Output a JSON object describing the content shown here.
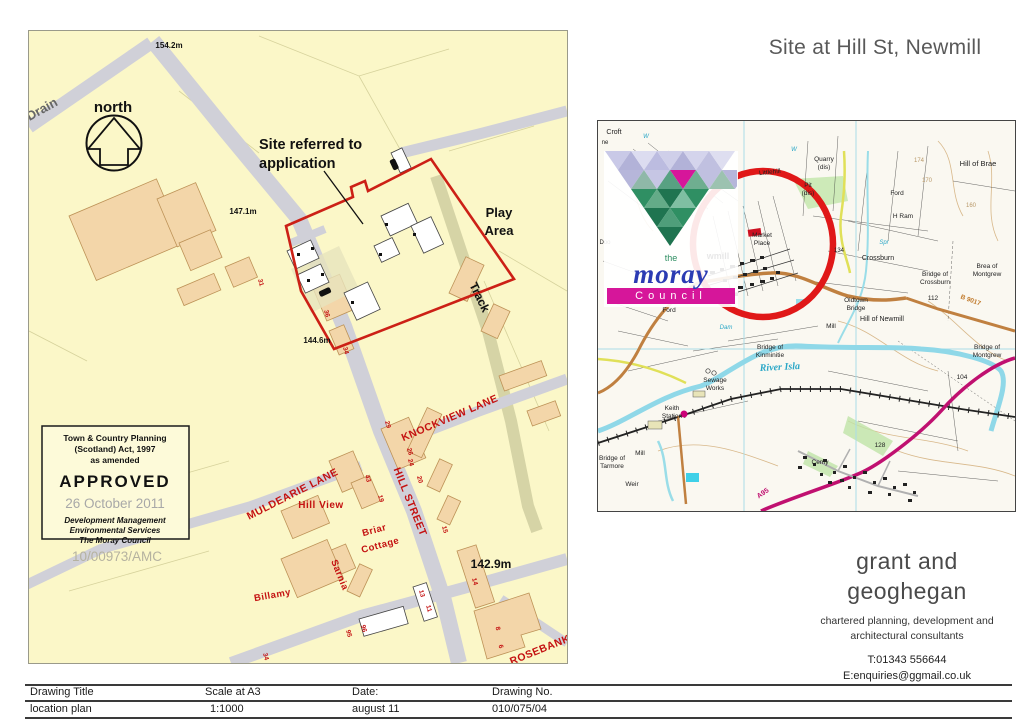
{
  "header": {
    "title": "Site at Hill St, Newmill"
  },
  "location_plan": {
    "site_note_line1": "Site referred to",
    "site_note_line2": "application",
    "labels": [
      {
        "t": "Drain",
        "x": 15,
        "y": 82,
        "s": 13,
        "c": "gray2",
        "r": -29
      },
      {
        "t": "north",
        "x": 84,
        "y": 81,
        "s": 15,
        "c": "blk"
      },
      {
        "t": "154.2m",
        "x": 140,
        "y": 17,
        "s": 8,
        "c": "blk"
      },
      {
        "t": "147.1m",
        "x": 214,
        "y": 183,
        "s": 8,
        "c": "blk"
      },
      {
        "t": "144.6m",
        "x": 288,
        "y": 312,
        "s": 8,
        "c": "blk"
      },
      {
        "t": "142.9m",
        "x": 462,
        "y": 537,
        "s": 12,
        "c": "blk"
      },
      {
        "t": "Play",
        "x": 470,
        "y": 186,
        "s": 13,
        "c": "blk"
      },
      {
        "t": "Area",
        "x": 470,
        "y": 204,
        "s": 13,
        "c": "blk"
      },
      {
        "t": "Track",
        "x": 447,
        "y": 268,
        "s": 12,
        "c": "blk",
        "r": 64
      },
      {
        "t": "KNOCKVIEW LANE",
        "x": 422,
        "y": 390,
        "s": 10.5,
        "c": "street",
        "r": -23
      },
      {
        "t": "HILL STREET",
        "x": 378,
        "y": 472,
        "s": 10.5,
        "c": "street",
        "r": 68
      },
      {
        "t": "MULDEARIE LANE",
        "x": 265,
        "y": 466,
        "s": 10.5,
        "c": "street",
        "r": -27
      },
      {
        "t": "ROSEBANK L",
        "x": 517,
        "y": 620,
        "s": 10.5,
        "c": "street",
        "r": -22
      },
      {
        "t": "Hill View",
        "x": 292,
        "y": 477,
        "s": 10,
        "c": "street"
      },
      {
        "t": "Briar",
        "x": 346,
        "y": 502,
        "s": 9.5,
        "c": "street",
        "r": -15
      },
      {
        "t": "Cottage",
        "x": 352,
        "y": 517,
        "s": 9.5,
        "c": "street",
        "r": -15
      },
      {
        "t": "Sarnia",
        "x": 308,
        "y": 545,
        "s": 9.5,
        "c": "street",
        "r": 68
      },
      {
        "t": "Billamy",
        "x": 244,
        "y": 567,
        "s": 9.5,
        "c": "street",
        "r": -10
      }
    ],
    "numbers": [
      {
        "t": "31",
        "x": 230,
        "y": 252,
        "s": 6.5,
        "c": "num",
        "r": 75
      },
      {
        "t": "36",
        "x": 296,
        "y": 283,
        "s": 6.5,
        "c": "num",
        "r": 75
      },
      {
        "t": "34",
        "x": 315,
        "y": 320,
        "s": 6.5,
        "c": "num",
        "r": 75
      },
      {
        "t": "29",
        "x": 357,
        "y": 394,
        "s": 6.5,
        "c": "num",
        "r": 75
      },
      {
        "t": "43",
        "x": 337,
        "y": 448,
        "s": 6.5,
        "c": "num",
        "r": 75
      },
      {
        "t": "19",
        "x": 350,
        "y": 468,
        "s": 6.5,
        "c": "num",
        "r": 75
      },
      {
        "t": "26",
        "x": 379,
        "y": 421,
        "s": 6.5,
        "c": "num",
        "r": 75
      },
      {
        "t": "24",
        "x": 380,
        "y": 432,
        "s": 6.5,
        "c": "num",
        "r": 75
      },
      {
        "t": "20",
        "x": 389,
        "y": 449,
        "s": 6.5,
        "c": "num",
        "r": 75
      },
      {
        "t": "15",
        "x": 414,
        "y": 499,
        "s": 6.5,
        "c": "num",
        "r": 75
      },
      {
        "t": "13",
        "x": 391,
        "y": 563,
        "s": 6.5,
        "c": "num",
        "r": 75
      },
      {
        "t": "11",
        "x": 398,
        "y": 578,
        "s": 6.5,
        "c": "num",
        "r": 75
      },
      {
        "t": "95",
        "x": 318,
        "y": 603,
        "s": 6.5,
        "c": "num",
        "r": 75
      },
      {
        "t": "96",
        "x": 333,
        "y": 598,
        "s": 6.5,
        "c": "num",
        "r": 75
      },
      {
        "t": "14",
        "x": 444,
        "y": 551,
        "s": 6.5,
        "c": "num",
        "r": 75
      },
      {
        "t": "8",
        "x": 467,
        "y": 598,
        "s": 6.5,
        "c": "num",
        "r": 75
      },
      {
        "t": "6",
        "x": 470,
        "y": 616,
        "s": 6.5,
        "c": "num",
        "r": 75
      },
      {
        "t": "34",
        "x": 235,
        "y": 626,
        "s": 6.5,
        "c": "num",
        "r": 75
      }
    ],
    "stamp": {
      "line1": "Town & Country Planning",
      "line2": "(Scotland) Act, 1997",
      "line3": "as amended",
      "approved": "APPROVED",
      "date": "26 October 2011",
      "dept1": "Development Management",
      "dept2": "Environmental Services",
      "dept3": "The Moray Council",
      "ref": "10/00973/AMC"
    }
  },
  "os_map": {
    "labels": [
      {
        "t": "Croft",
        "x": 16,
        "y": 13,
        "s": 7,
        "c": "os"
      },
      {
        "t": "ne",
        "x": 7,
        "y": 23,
        "s": 6,
        "c": "os"
      },
      {
        "t": "W",
        "x": 48,
        "y": 17,
        "s": 6,
        "c": "osc"
      },
      {
        "t": "W",
        "x": 196,
        "y": 30,
        "s": 6,
        "c": "osc"
      },
      {
        "t": "Quarry",
        "x": 226,
        "y": 40,
        "s": 6.5,
        "c": "os"
      },
      {
        "t": "(dis)",
        "x": 226,
        "y": 48,
        "s": 6.5,
        "c": "os"
      },
      {
        "t": "Littlehill",
        "x": 172,
        "y": 53,
        "s": 6.5,
        "c": "os",
        "r": -6
      },
      {
        "t": "Pit",
        "x": 210,
        "y": 66,
        "s": 6.5,
        "c": "os"
      },
      {
        "t": "(dis)",
        "x": 210,
        "y": 74,
        "s": 6.5,
        "c": "os"
      },
      {
        "t": "Hill of Brae",
        "x": 380,
        "y": 45,
        "s": 7.5,
        "c": "os"
      },
      {
        "t": "174",
        "x": 321,
        "y": 41,
        "s": 6,
        "c": "ost"
      },
      {
        "t": "170",
        "x": 329,
        "y": 61,
        "s": 6,
        "c": "ost"
      },
      {
        "t": "160",
        "x": 373,
        "y": 86,
        "s": 6,
        "c": "ost"
      },
      {
        "t": "Ford",
        "x": 299,
        "y": 74,
        "s": 6.5,
        "c": "os"
      },
      {
        "t": "H Ram",
        "x": 305,
        "y": 97,
        "s": 6.5,
        "c": "os"
      },
      {
        "t": "Spr",
        "x": 286,
        "y": 123,
        "s": 6,
        "c": "osc"
      },
      {
        "t": "Crossburn",
        "x": 280,
        "y": 139,
        "s": 7,
        "c": "os"
      },
      {
        "t": "Bridge of",
        "x": 337,
        "y": 155,
        "s": 6.5,
        "c": "os"
      },
      {
        "t": "Crossburn",
        "x": 337,
        "y": 163,
        "s": 6.5,
        "c": "os"
      },
      {
        "t": "Brea of",
        "x": 389,
        "y": 147,
        "s": 6.5,
        "c": "os"
      },
      {
        "t": "Montgrew",
        "x": 389,
        "y": 155,
        "s": 6.5,
        "c": "os"
      },
      {
        "t": "112",
        "x": 335,
        "y": 179,
        "s": 6.5,
        "c": "os"
      },
      {
        "t": "B 9017",
        "x": 372,
        "y": 181,
        "s": 6.5,
        "c": "oso",
        "r": 20
      },
      {
        "t": "Oldtown",
        "x": 258,
        "y": 181,
        "s": 6.5,
        "c": "os"
      },
      {
        "t": "Bridge",
        "x": 258,
        "y": 189,
        "s": 6.5,
        "c": "os"
      },
      {
        "t": "Hill of Newmill",
        "x": 284,
        "y": 200,
        "s": 7,
        "c": "os"
      },
      {
        "t": "Mill",
        "x": 233,
        "y": 207,
        "s": 6.5,
        "c": "os"
      },
      {
        "t": "134",
        "x": 241,
        "y": 131,
        "s": 6,
        "c": "os"
      },
      {
        "t": "Market",
        "x": 164,
        "y": 116,
        "s": 6.5,
        "c": "os"
      },
      {
        "t": "Place",
        "x": 164,
        "y": 124,
        "s": 6.5,
        "c": "os"
      },
      {
        "t": "wmill",
        "x": 120,
        "y": 138,
        "s": 9,
        "c": "osbb"
      },
      {
        "t": "Dam",
        "x": 128,
        "y": 208,
        "s": 6,
        "c": "osc"
      },
      {
        "t": "Ford",
        "x": 71,
        "y": 191,
        "s": 6.5,
        "c": "os"
      },
      {
        "t": "Doo",
        "x": 7,
        "y": 123,
        "s": 6,
        "c": "os"
      },
      {
        "t": "Bridge of",
        "x": 172,
        "y": 228,
        "s": 6.5,
        "c": "os"
      },
      {
        "t": "Kinminitie",
        "x": 172,
        "y": 236,
        "s": 6.5,
        "c": "os"
      },
      {
        "t": "River Isla",
        "x": 182,
        "y": 249,
        "s": 10,
        "c": "oscb",
        "r": -3
      },
      {
        "t": "Sewage",
        "x": 117,
        "y": 261,
        "s": 6.5,
        "c": "os"
      },
      {
        "t": "Works",
        "x": 117,
        "y": 269,
        "s": 6.5,
        "c": "os"
      },
      {
        "t": "Keith",
        "x": 74,
        "y": 289,
        "s": 6.5,
        "c": "os"
      },
      {
        "t": "Station",
        "x": 74,
        "y": 297,
        "s": 6.5,
        "c": "os"
      },
      {
        "t": "Mill",
        "x": 42,
        "y": 334,
        "s": 6.5,
        "c": "os"
      },
      {
        "t": "Bridge of",
        "x": 14,
        "y": 339,
        "s": 6.5,
        "c": "os"
      },
      {
        "t": "Tarmore",
        "x": 14,
        "y": 347,
        "s": 6.5,
        "c": "os"
      },
      {
        "t": "Weir",
        "x": 34,
        "y": 365,
        "s": 6.5,
        "c": "os"
      },
      {
        "t": "Cemy",
        "x": 222,
        "y": 343,
        "s": 6.5,
        "c": "os"
      },
      {
        "t": "128",
        "x": 282,
        "y": 326,
        "s": 6.5,
        "c": "os"
      },
      {
        "t": "104",
        "x": 364,
        "y": 258,
        "s": 6.5,
        "c": "os"
      },
      {
        "t": "Bridge of",
        "x": 389,
        "y": 228,
        "s": 6.5,
        "c": "os"
      },
      {
        "t": "Montgrew",
        "x": 389,
        "y": 236,
        "s": 6.5,
        "c": "os"
      },
      {
        "t": "A95",
        "x": 166,
        "y": 374,
        "s": 7,
        "c": "osm",
        "r": -35
      }
    ]
  },
  "logo": {
    "the": "the",
    "moray": "moray",
    "council": "Council",
    "mosaic": [
      [
        "#c9c9e7",
        "#b2b2d8",
        "#dcdcf0",
        "#bcbce0",
        "#cfcfe9",
        "#b2b2d8",
        "#d4d4ec",
        "#c0c0e0",
        "#dedef0"
      ],
      [
        "#b6b6da",
        "#8fb8a8",
        "#c6c6e4",
        "#58a182",
        "#d6169a",
        "#6fae90",
        "#c0c0e0",
        "#9cc2b0",
        "#b6b6da"
      ],
      [
        "#2f8f63",
        "#64ab88",
        "#1f7450",
        "#7fbfa2",
        "#2f8f63"
      ],
      [
        "#1f7450",
        "#4f9e7a",
        "#2f8f63"
      ],
      [
        "#1f7450"
      ]
    ]
  },
  "firm": {
    "name1": "grant and",
    "name2": "geoghegan",
    "tag1": "chartered planning, development and",
    "tag2": "architectural consultants",
    "phone": "T:01343 556644",
    "email": "E:enquiries@ggmail.co.uk"
  },
  "title_block": {
    "headers": [
      "Drawing Title",
      "Scale at A3",
      "Date:",
      "Drawing No."
    ],
    "values": [
      "location plan",
      "1:1000",
      "august 11",
      "010/075/04"
    ]
  },
  "colors": {
    "map_bg": "#fbf7c8",
    "building": "#f3d6a9",
    "road_grey": "#d0d0d8",
    "track_olive": "#d6d4a6",
    "boundary_red": "#cc2016",
    "street_red": "#c41111",
    "os_circle_red": "#e01818",
    "river_cyan": "#8fd8e8",
    "a_road_magenta": "#c01070",
    "b_road_orange": "#c08040",
    "logo_magenta": "#d6169a",
    "logo_blue": "#2b3bb3",
    "title_gray": "#595959"
  }
}
